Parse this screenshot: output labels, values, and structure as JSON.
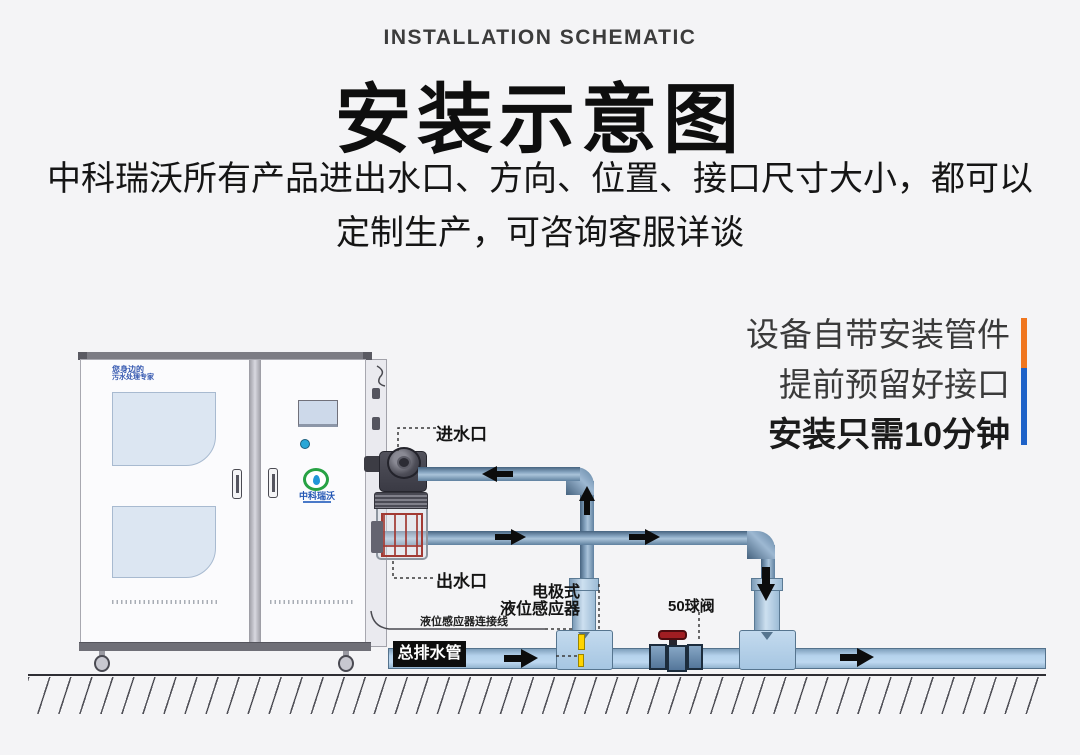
{
  "page": {
    "background": "#f4f4f6"
  },
  "header": {
    "eyebrow": "INSTALLATION SCHEMATIC",
    "title": "安装示意图",
    "subtitle_line1": "中科瑞沃所有产品进出水口、方向、位置、接口尺寸大小，都可以",
    "subtitle_line2": "定制生产，可咨询客服详谈"
  },
  "promo": {
    "line1": "设备自带安装管件",
    "line2": "提前预留好接口",
    "line3": "安装只需10分钟",
    "accent_orange": "#f0761e",
    "accent_blue": "#1e62c8"
  },
  "machine": {
    "brand_line1": "您身边的",
    "brand_line2": "污水处理专家",
    "logo_text": "中科瑞沃"
  },
  "diagram_labels": {
    "inlet": "进水口",
    "outlet": "出水口",
    "sensor_line1": "电极式",
    "sensor_line2": "液位感应器",
    "sensor_cable": "液位感应器连接线",
    "main_drain": "总排水管",
    "ball_valve": "50球阀"
  },
  "colors": {
    "pipe_dark": "#46637f",
    "pipe_light": "#aac3d9",
    "drain_pipe_fill": "#b5d2ec",
    "fitting_fill": "#b9d4ea",
    "valve_handle_red": "#a01d22",
    "sensor_yellow": "#ffd400",
    "ground": "#2e2e34"
  }
}
